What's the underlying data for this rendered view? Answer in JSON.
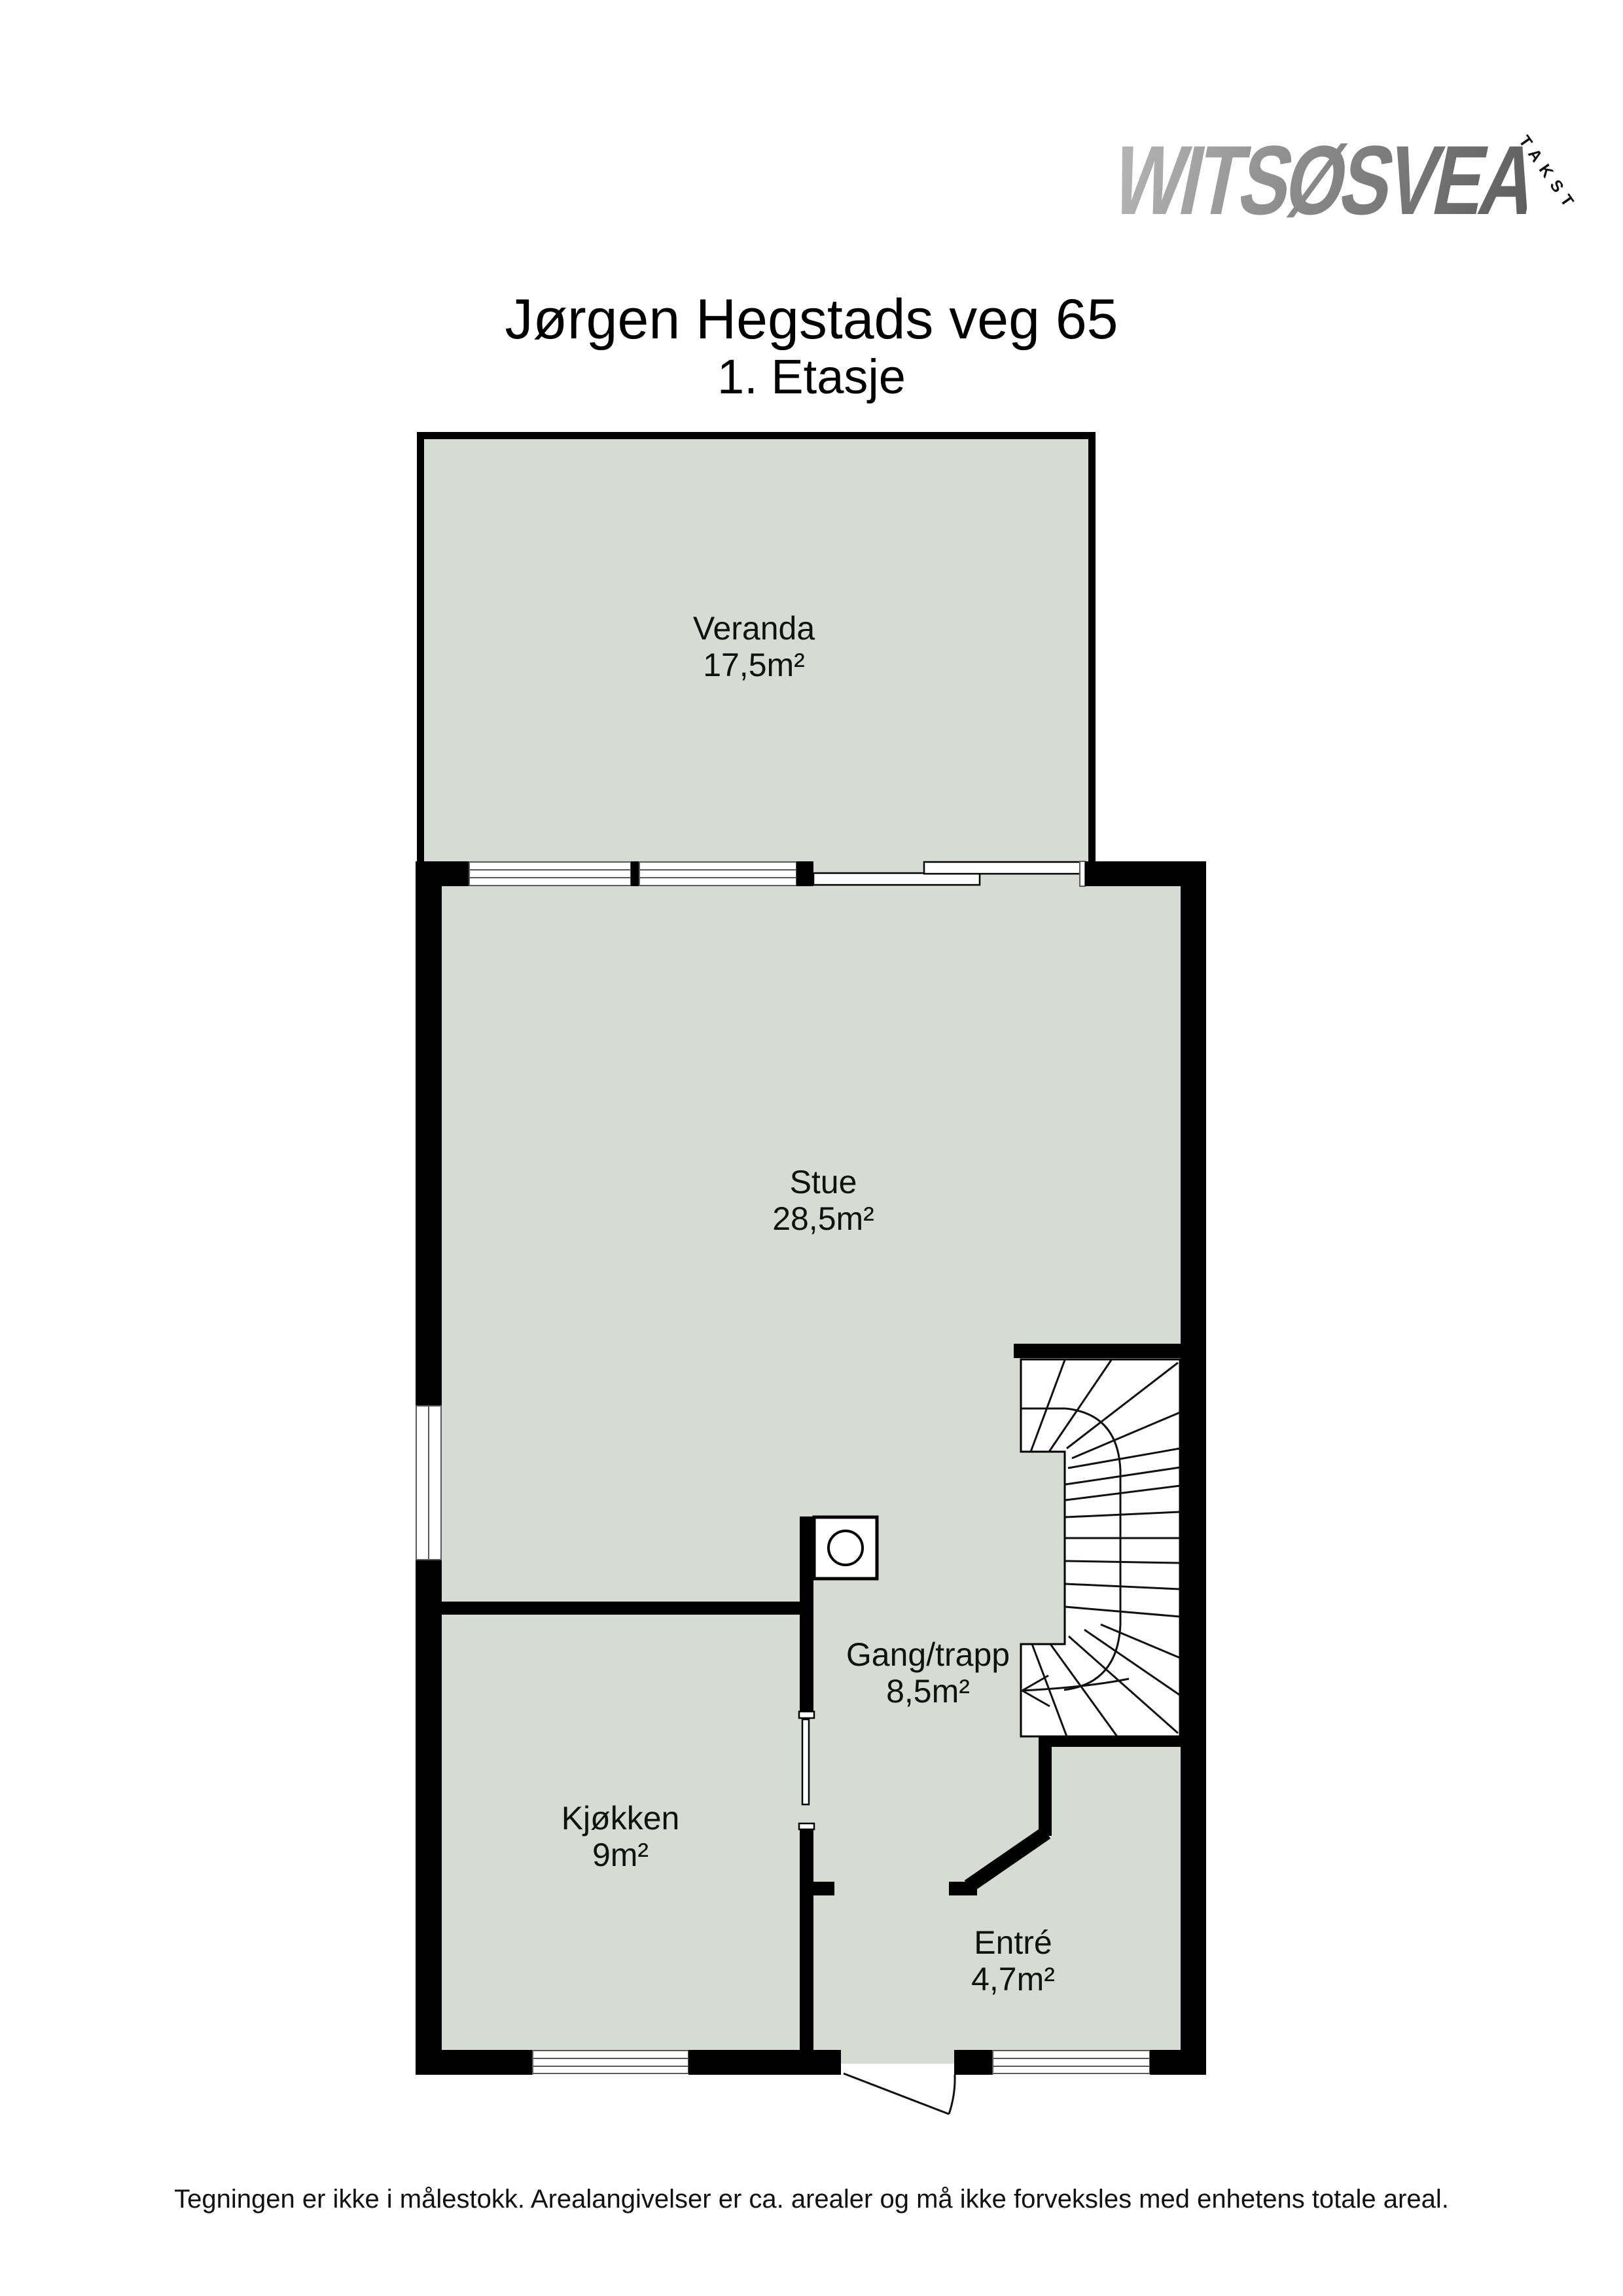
{
  "logo": {
    "brand": "WITSØSVEA",
    "tagline": "TAKST"
  },
  "header": {
    "title": "Jørgen Hegstads veg 65",
    "subtitle": "1. Etasje"
  },
  "rooms": [
    {
      "name": "Veranda",
      "area": "17,5m²"
    },
    {
      "name": "Stue",
      "area": "28,5m²"
    },
    {
      "name": "Gang/trapp",
      "area": "8,5m²"
    },
    {
      "name": "Kjøkken",
      "area": "9m²"
    },
    {
      "name": "Entré",
      "area": "4,7m²"
    }
  ],
  "footer": {
    "disclaimer": "Tegningen er ikke i målestokk. Arealangivelser er ca. arealer og må ikke forveksles med enhetens totale areal."
  },
  "colors": {
    "floor_fill": "#d6dbd3",
    "wall": "#000000",
    "window_frame": "#5a5a5a",
    "logo_gradient_start": "#b5b5b5",
    "logo_gradient_end": "#5e5e5e"
  }
}
